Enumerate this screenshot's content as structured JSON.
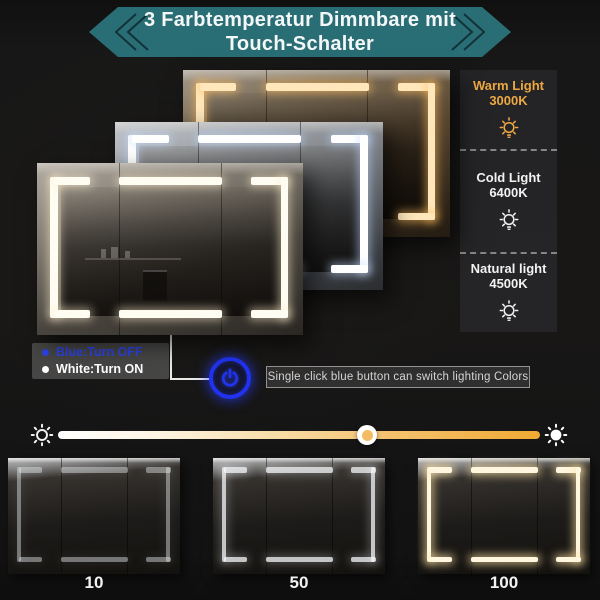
{
  "title": {
    "line1": "3 Farbtemperatur Dimmbare mit",
    "line2": "Touch-Schalter"
  },
  "banner_color": "#2a6e75",
  "light_modes": [
    {
      "label": "Warm Light",
      "kelvin": "3000K",
      "color": "#eda843",
      "led_color": "#ffe7bb"
    },
    {
      "label": "Cold Light",
      "kelvin": "6400K",
      "color": "#f2f2f2",
      "led_color": "#ffffff"
    },
    {
      "label": "Natural light",
      "kelvin": "4500K",
      "color": "#f2f2f2",
      "led_color": "#fffdf2"
    }
  ],
  "legend": {
    "off_label": "Blue:Turn OFF",
    "off_color": "#2e45ec",
    "on_label": "White:Turn ON",
    "on_color": "#ffffff"
  },
  "touch_tip": "Single click blue button can switch lighting Colors",
  "power_button_color": "#2133f0",
  "dimmer": {
    "value_percent": 64,
    "track_start_color": "#ffffff",
    "track_end_color": "#f0a933",
    "levels": [
      "10",
      "50",
      "100"
    ]
  }
}
